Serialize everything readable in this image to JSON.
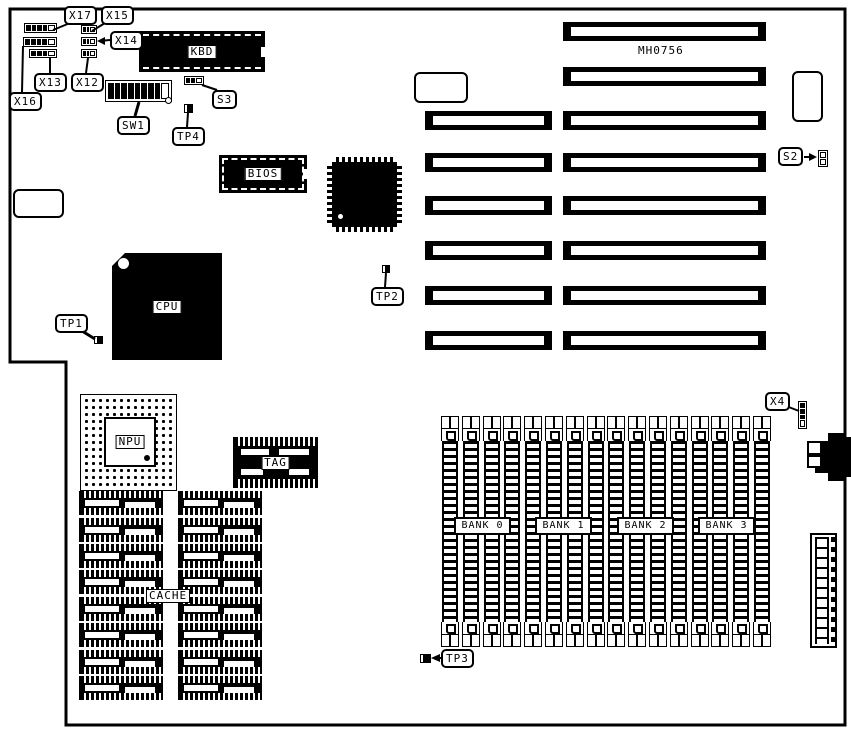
{
  "board": {
    "part_number": "MH0756",
    "colors": {
      "ink": "#000000",
      "paper": "#ffffff"
    }
  },
  "connector_callouts": {
    "x17": "X17",
    "x15": "X15",
    "x14": "X14",
    "x13": "X13",
    "x12": "X12",
    "x16": "X16",
    "x4": "X4"
  },
  "switch_callouts": {
    "sw1": "SW1",
    "s2": "S2",
    "s3": "S3"
  },
  "testpoint_callouts": {
    "tp1": "TP1",
    "tp2": "TP2",
    "tp3": "TP3",
    "tp4": "TP4"
  },
  "chip_labels": {
    "kbd": "KBD",
    "bios": "BIOS",
    "cpu": "CPU",
    "npu": "NPU",
    "tag": "TAG",
    "cache": "CACHE"
  },
  "memory_banks": {
    "bank0": "BANK 0",
    "bank1": "BANK 1",
    "bank2": "BANK 2",
    "bank3": "BANK 3"
  }
}
